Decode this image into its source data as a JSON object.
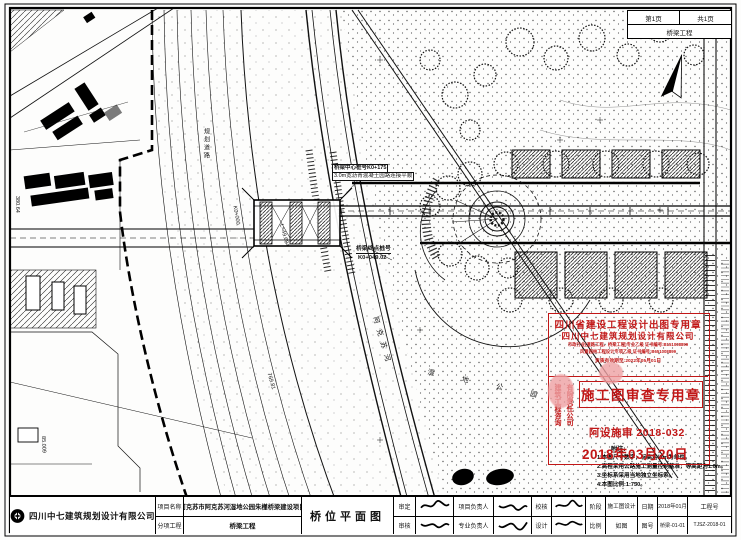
{
  "sheet_corner": {
    "page": "第1页",
    "total": "共1页",
    "discipline": "桥梁工程"
  },
  "plan_labels": {
    "bridge_center_station": "桥梁中心桩号K0+175",
    "bridge_center_note": "3.0m宽沥青混凝土园路连接平顺",
    "bridge_end_label": "桥梁终点桩号",
    "bridge_end_station": "K0+049.02",
    "align_1": "L=49.684",
    "align_2": "K0+000",
    "align_3": "769.81",
    "align_4": "380.64",
    "align_5": "85.009",
    "road_1": "规划道路",
    "river": "阿克苏河",
    "park": "湿 地 公 园"
  },
  "stamps": {
    "design_seal": {
      "title": "四川省建设工程设计出图专用章",
      "company": "四川中七建筑规划设计有限公司",
      "cert_line1": "市政行业(道路工程、桥梁工程)专业乙级 证书编号:B151008899",
      "cert_line2": "风景园林工程设计专项乙级 证书编号:B651008899",
      "valid_line": "资质有效期至:2022年05月01日"
    },
    "review_seal": {
      "title": "施工图审查专用章",
      "company_col1": "建筑工程咨询",
      "company_col2": "有限责任公司",
      "review_no": "阿设施审 2018-032",
      "review_date": "2018年03月20日"
    }
  },
  "notes": {
    "title": "附注:",
    "items": [
      "1.本图尺寸数字，标高均以m为单位。",
      "2.高程采用公路施工测量控制基准，等高距为1.0m。",
      "3.坐标系采用当地独立坐标系。",
      "4.本图比例:1:750。"
    ]
  },
  "title_block": {
    "company": "四川中七建筑规划设计有限公司",
    "project_label": "项目名称",
    "project_name": "阿克苏市阿克苏河湿地公园朱槿桥梁建设项目",
    "subitem_label": "分项工程",
    "subitem_name": "桥梁工程",
    "drawing_title": "桥位平面图",
    "approve_label": "审定",
    "review_label": "审核",
    "pm_label": "项目负责人",
    "lead_label": "专业负责人",
    "check_label": "校核",
    "design_label": "设计",
    "stage_label": "阶段",
    "stage_value": "施工图设计",
    "scale_label": "比例",
    "scale_value": "如图",
    "date_label": "日期",
    "date_value": "2018年01月",
    "figno_label": "图号",
    "figno_value": "桥梁-01-01",
    "projno_label": "工程号",
    "projno_value": "TJSZ-2018-01"
  }
}
